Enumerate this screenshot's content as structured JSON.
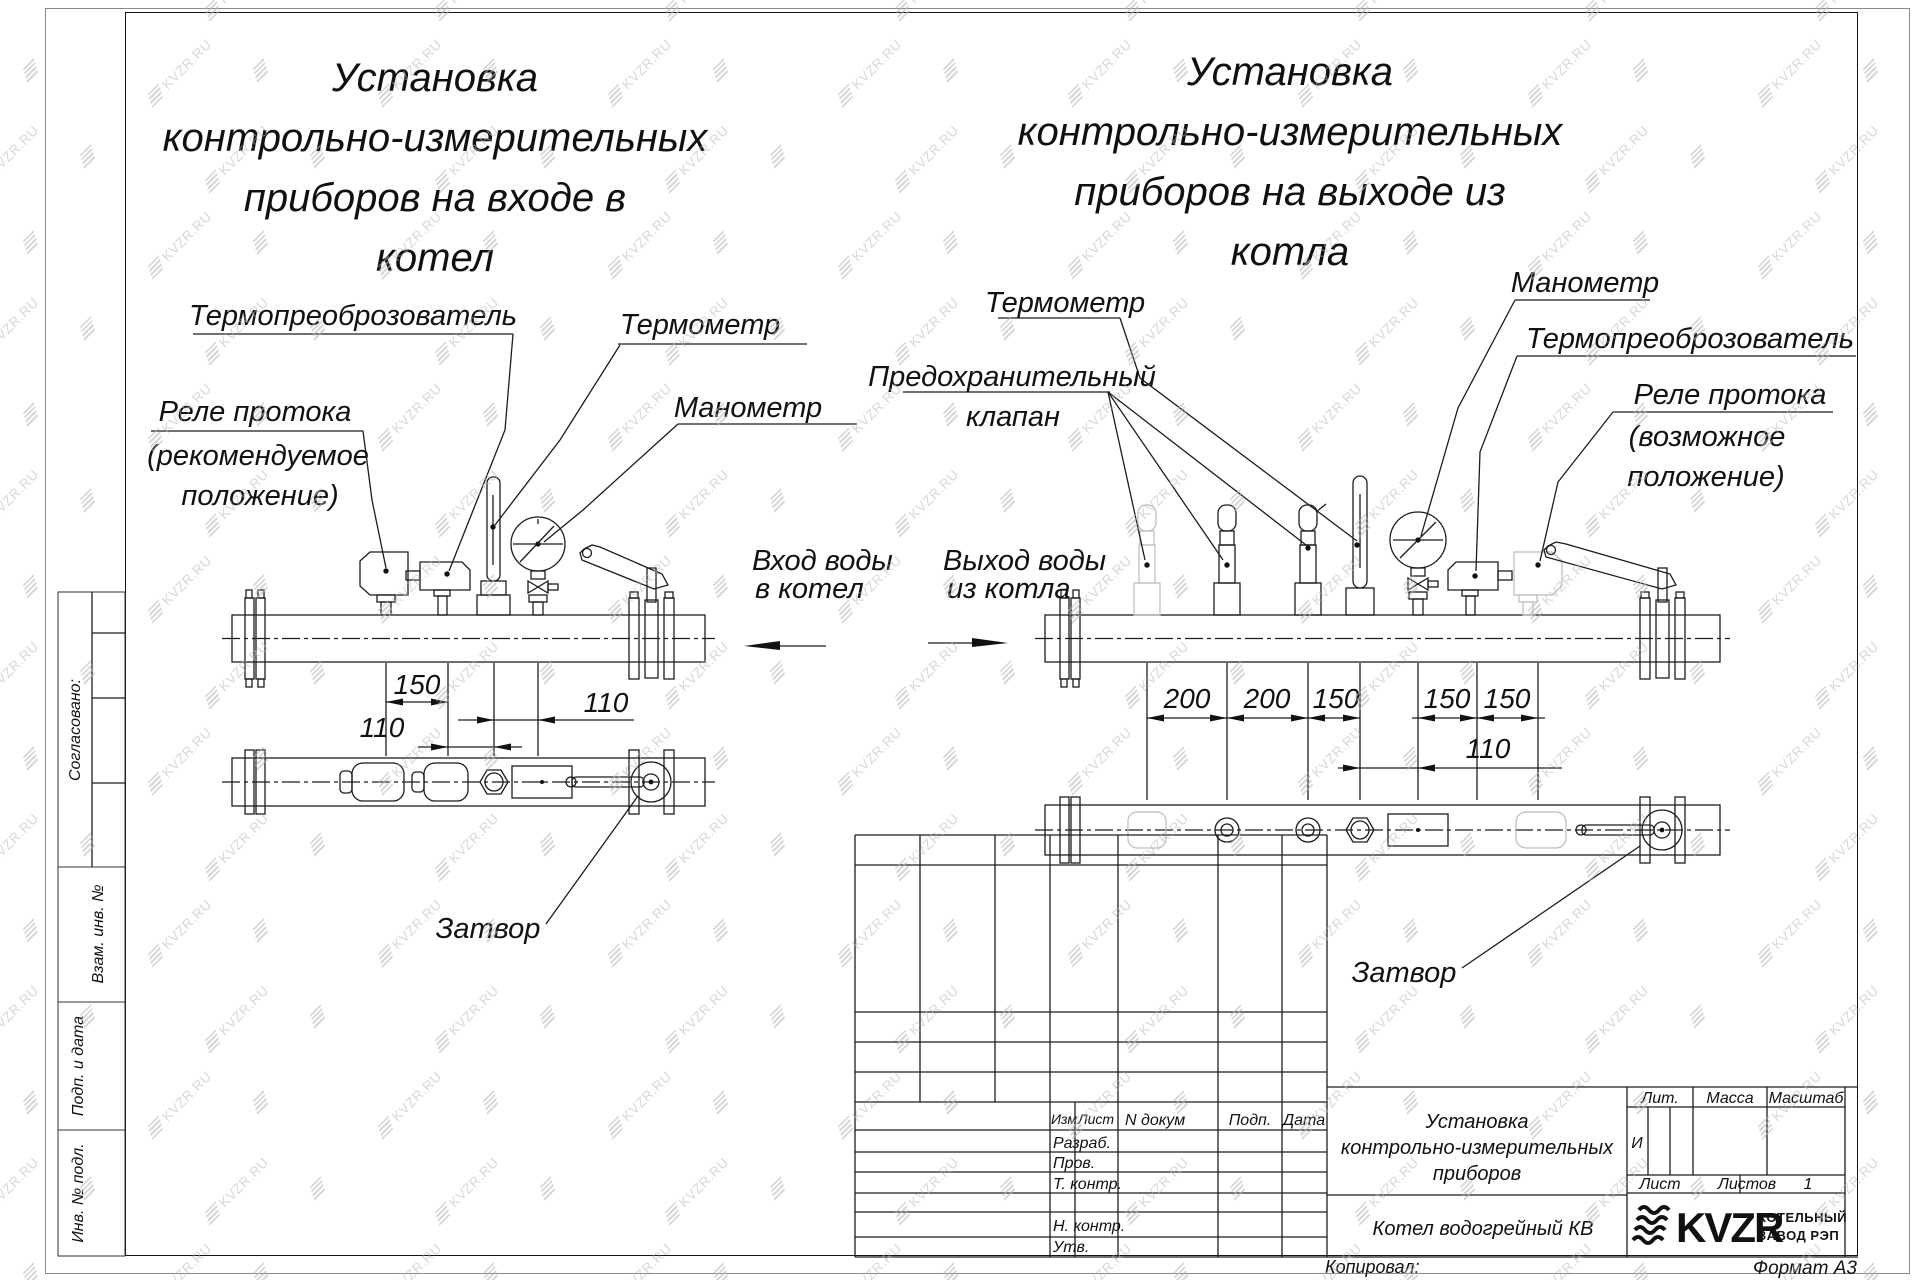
{
  "watermark": {
    "text": "KVZR.RU"
  },
  "left_title": {
    "lines": [
      "Установка",
      "контрольно-измерительных",
      "приборов на входе в",
      "котел"
    ]
  },
  "right_title": {
    "lines": [
      "Установка",
      "контрольно-измерительных",
      "приборов на выходе из",
      "котла"
    ]
  },
  "left_view": {
    "labels": {
      "transducer": "Термопреоброзователь",
      "flow_relay": [
        "Реле протока",
        "(рекомендуемое",
        "положение)"
      ],
      "thermometer": "Термометр",
      "manometer": "Манометр",
      "valve": "Затвор"
    },
    "dims": {
      "a": "150",
      "b": "110",
      "c": "110"
    },
    "flow": [
      "Вход воды",
      "в котел"
    ]
  },
  "right_view": {
    "labels": {
      "thermometer": "Термометр",
      "safety_valve": [
        "Предохранительный",
        "клапан"
      ],
      "manometer": "Манометр",
      "transducer": "Термопреоброзователь",
      "flow_relay": [
        "Реле протока",
        "(возможное",
        "положение)"
      ],
      "valve": "Затвор"
    },
    "dims": {
      "a": "200",
      "b": "200",
      "c": "150",
      "d": "150",
      "e": "150",
      "f": "110"
    },
    "flow": [
      "Выход воды",
      "из котла"
    ]
  },
  "sidebar": {
    "agreed": "Согласовано:",
    "vzam": "Взам. инв. №",
    "podp_data": "Подп. и дата",
    "inv": "Инв. № подл."
  },
  "title_block": {
    "cols": {
      "izm": "Изм",
      "list": "Лист",
      "doc": "N докум",
      "podp": "Подп.",
      "data": "Дата"
    },
    "rows": {
      "razrab": "Разраб.",
      "prov": "Пров.",
      "tkontr": "Т. контр.",
      "nkontr": "Н. контр.",
      "utv": "Утв."
    },
    "name_lines": [
      "Установка",
      "контрольно-измерительных",
      "приборов"
    ],
    "product": "Котел водогрейный КВ",
    "lit": "Лит.",
    "mass": "Масса",
    "scale": "Масштаб",
    "lit_value": "И",
    "sheet": "Лист",
    "sheets": "Листов",
    "sheets_value": "1",
    "logo": "KVZR",
    "company": [
      "КОТЕЛЬНЫЙ",
      "ЗАВОД РЭП"
    ],
    "copied": "Копировал:",
    "format": "Формат А3"
  }
}
